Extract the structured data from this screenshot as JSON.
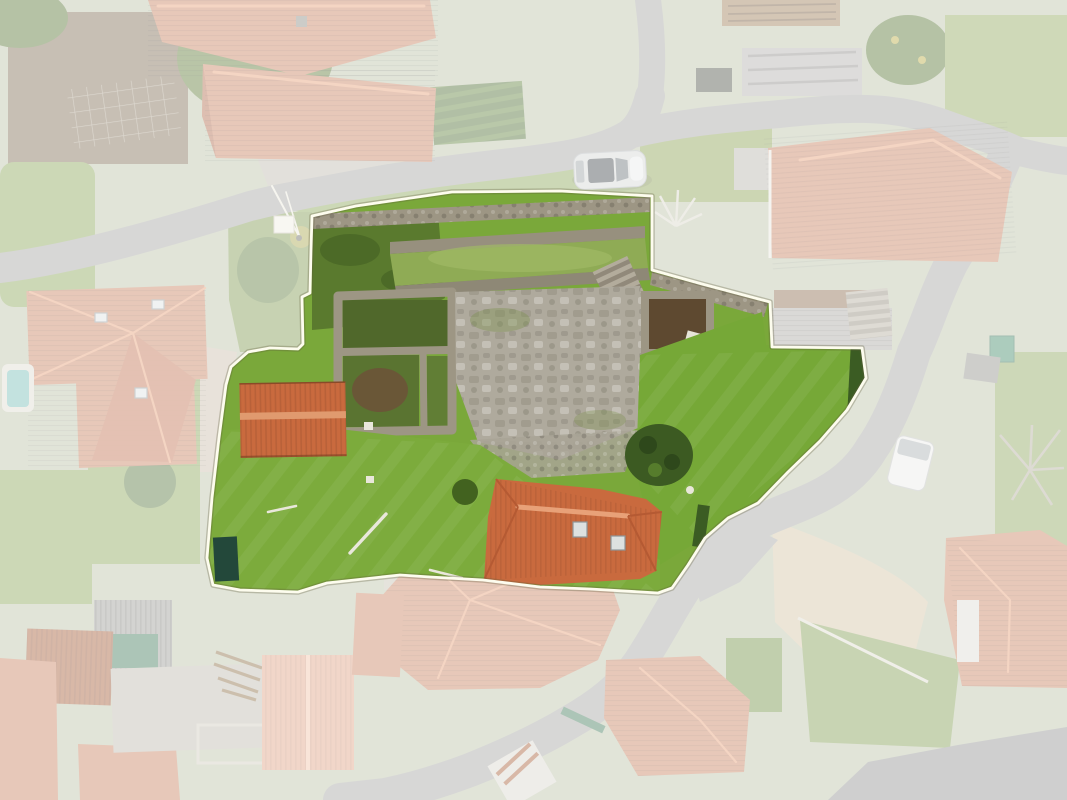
{
  "image": {
    "kind": "aerial-drone-photo",
    "view": "top-down orthographic",
    "subject": "Rural village property: central plot with stone ruins, lawns and two terracotta-roof buildings highlighted by a white boundary outline; surrounding houses, winding roads and gardens are desaturated by a white wash",
    "width_px": 1067,
    "height_px": 800
  },
  "plot": {
    "boundary_points": "312,216 356,206 452,192 560,191 652,196 652,270 702,284 770,302 772,347 862,348 866,378 847,410 820,441 788,472 758,503 728,518 705,538 688,565 672,588 658,593 590,589 540,587 483,580 430,577 400,575 327,583 298,592 240,590 213,585 207,558 212,498 219,438 226,385 231,367 248,352 270,348 298,349 303,344 302,297 310,293 311,250",
    "contents": [
      "stone ruin walls",
      "flagstone courtyard",
      "terraced stone walls",
      "green lawns",
      "small terracotta-roof outbuilding",
      "terracotta-roof house on south edge with two skylights",
      "dark green tree",
      "hedges",
      "dark tarp",
      "dark garden patch",
      "stone stairs"
    ]
  },
  "surroundings": {
    "contents": [
      "village houses with terracotta hip roofs",
      "winding asphalt roads",
      "vegetable garden rows",
      "small swimming pool",
      "construction site with slab and lumber",
      "corrugated sheds and rusty roofs",
      "stone walls",
      "bare winter trees",
      "tan gravel yard",
      "utility pole with guy wires"
    ]
  },
  "vehicles": [
    {
      "name": "silver-car",
      "location": "parked on the road above the plot"
    },
    {
      "name": "white-van",
      "location": "parked beside the road east of the plot"
    }
  ],
  "fade_overlay": {
    "color": "#ffffff",
    "opacity": "0.57"
  },
  "colors": {
    "ground": "#b9c0a6",
    "grassVivid": "#7aa83a",
    "grassEast": "#76a837",
    "lawnSouth": "#7cab3c",
    "grassFaded": "#8aa457",
    "soil": "#7d6b52",
    "stone": "#9d9684",
    "stoneLight": "#afaa9d",
    "roofVivid": "#c96a3e",
    "roofRidge": "#e59d74",
    "roofFaded": "#c87f5d",
    "roofSalmon": "#dfa183",
    "road": "#a3a3a0",
    "roadDark": "#8f9190",
    "concrete": "#bdb8ab",
    "tanYard": "#d2c3a3",
    "hedge": "#3b5c23",
    "bush": "#3c5a22",
    "tarp": "#23483a",
    "tealTank": "#3f8a66",
    "pool": "#74bcb6",
    "rust": "#a55a35",
    "grayShed": "#9a9a94",
    "dirtRoom": "#5e4930",
    "carSilver": "#d3d5d4",
    "carGlass": "#3e4448",
    "vanWhite": "#e9eae7",
    "boundary": "#fdfcee"
  }
}
